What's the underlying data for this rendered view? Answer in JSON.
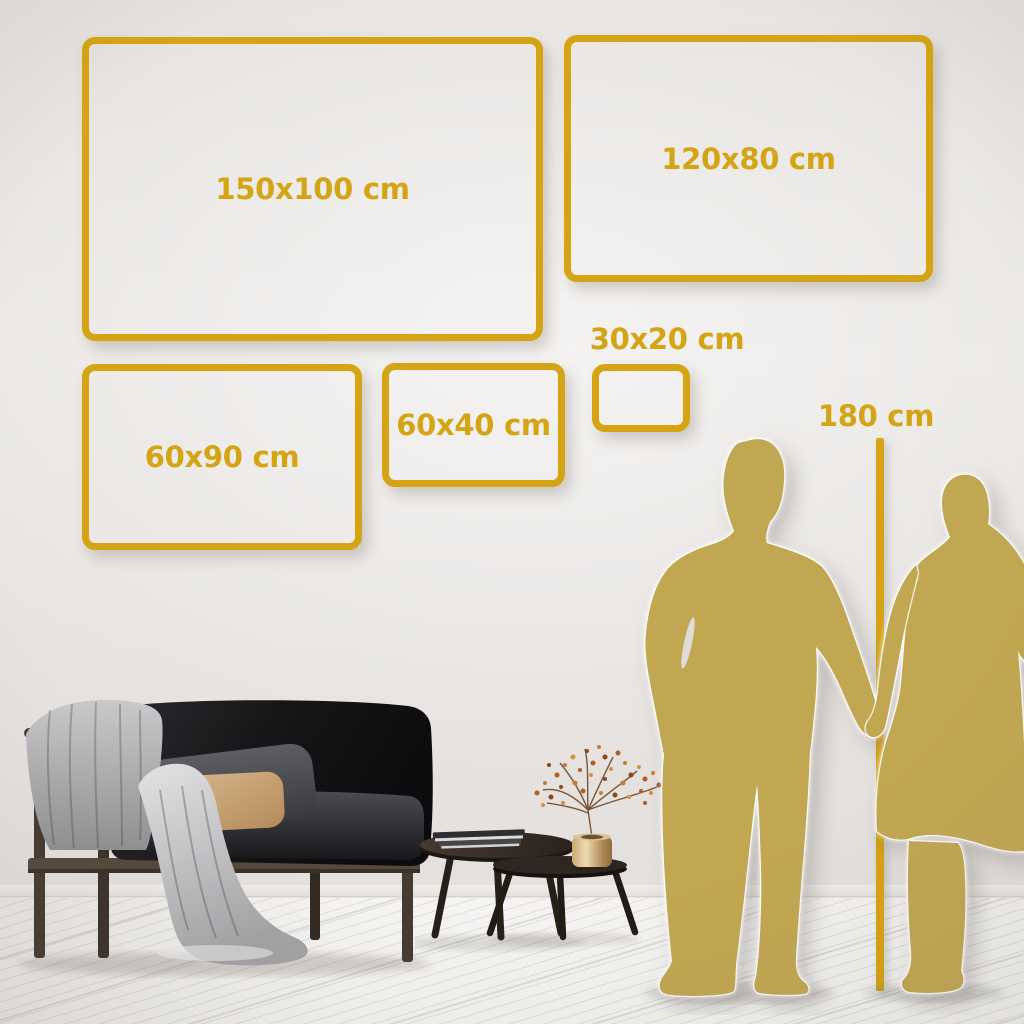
{
  "size_guide": {
    "unit": "cm",
    "boxes": [
      {
        "id": "150x100",
        "label": "150x100 cm",
        "width_cm": 150,
        "height_cm": 100
      },
      {
        "id": "120x80",
        "label": "120x80 cm",
        "width_cm": 120,
        "height_cm": 80
      },
      {
        "id": "60x90",
        "label": "60x90 cm",
        "width_cm": 60,
        "height_cm": 90
      },
      {
        "id": "60x40",
        "label": "60x40 cm",
        "width_cm": 60,
        "height_cm": 40
      },
      {
        "id": "30x20",
        "label": "30x20 cm",
        "width_cm": 30,
        "height_cm": 20
      }
    ],
    "height_reference": {
      "label": "180 cm",
      "value_cm": 180
    }
  },
  "colors": {
    "accent_gold": "#D5A414",
    "silhouette_gold": "#C2A752",
    "wall": "#E7E4E1",
    "floor": "#F3F2F0"
  },
  "scene": {
    "objects": [
      "sofa-with-throw-blanket",
      "nesting-coffee-tables",
      "dried-branch-vase",
      "couple-silhouette",
      "height-ruler"
    ]
  }
}
